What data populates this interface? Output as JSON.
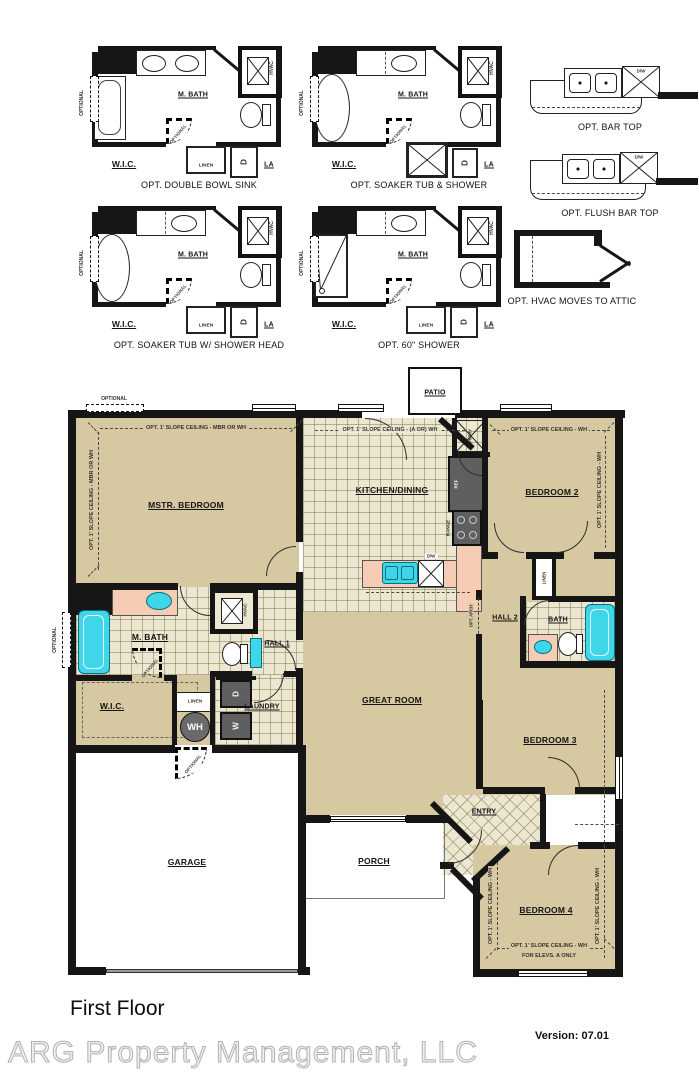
{
  "footer": {
    "title": "First Floor",
    "version": "Version: 07.01",
    "watermark": "ARG Property Management, LLC"
  },
  "captions": {
    "opt_a": "OPT. DOUBLE BOWL SINK",
    "opt_b": "OPT. SOAKER TUB & SHOWER",
    "opt_c": "OPT. SOAKER TUB W/ SHOWER HEAD",
    "opt_d": "OPT. 60\" SHOWER",
    "bar_top": "OPT. BAR TOP",
    "flush_bar_top": "OPT. FLUSH BAR TOP",
    "hvac_attic": "OPT. HVAC MOVES TO ATTIC"
  },
  "rooms": {
    "patio": "PATIO",
    "mstr_bedroom": "MSTR. BEDROOM",
    "kitchen": "KITCHEN/DINING",
    "bedroom2": "BEDROOM 2",
    "bedroom3": "BEDROOM 3",
    "bedroom4": "BEDROOM 4",
    "great_room": "GREAT ROOM",
    "hall1": "HALL 1",
    "hall2": "HALL 2",
    "bath": "BATH",
    "entry": "ENTRY",
    "porch": "PORCH",
    "garage": "GARAGE"
  },
  "labels": {
    "mbath": "M. BATH",
    "wic": "W.I.C.",
    "linen": "LINEN",
    "d": "D",
    "w": "W",
    "la": "LA",
    "hvac": "HVAC",
    "optional": "OPTIONAL",
    "dw": "D/W",
    "ref": "REF",
    "range": "RANGE",
    "pntry": "PNTRY",
    "wh": "WH",
    "laundry": "LAUNDRY",
    "opt_arch": "OPT. ARCH"
  },
  "ceiling": {
    "mbr": "OPT. 1' SLOPE CEILING - MBR OR WH",
    "wh_only": "OPT. 1' SLOPE CEILING - WH",
    "kitchen": "OPT. 1' SLOPE CEILING - (A OR) WH",
    "elevs": "FOR ELEVS. A ONLY"
  },
  "colors": {
    "room_fill": "#d6c8a0",
    "tile_fill": "#ece7d1",
    "counter_fill": "#f6cdb4",
    "fixture_cyan": "#3ed6e8",
    "wall": "#161616"
  }
}
